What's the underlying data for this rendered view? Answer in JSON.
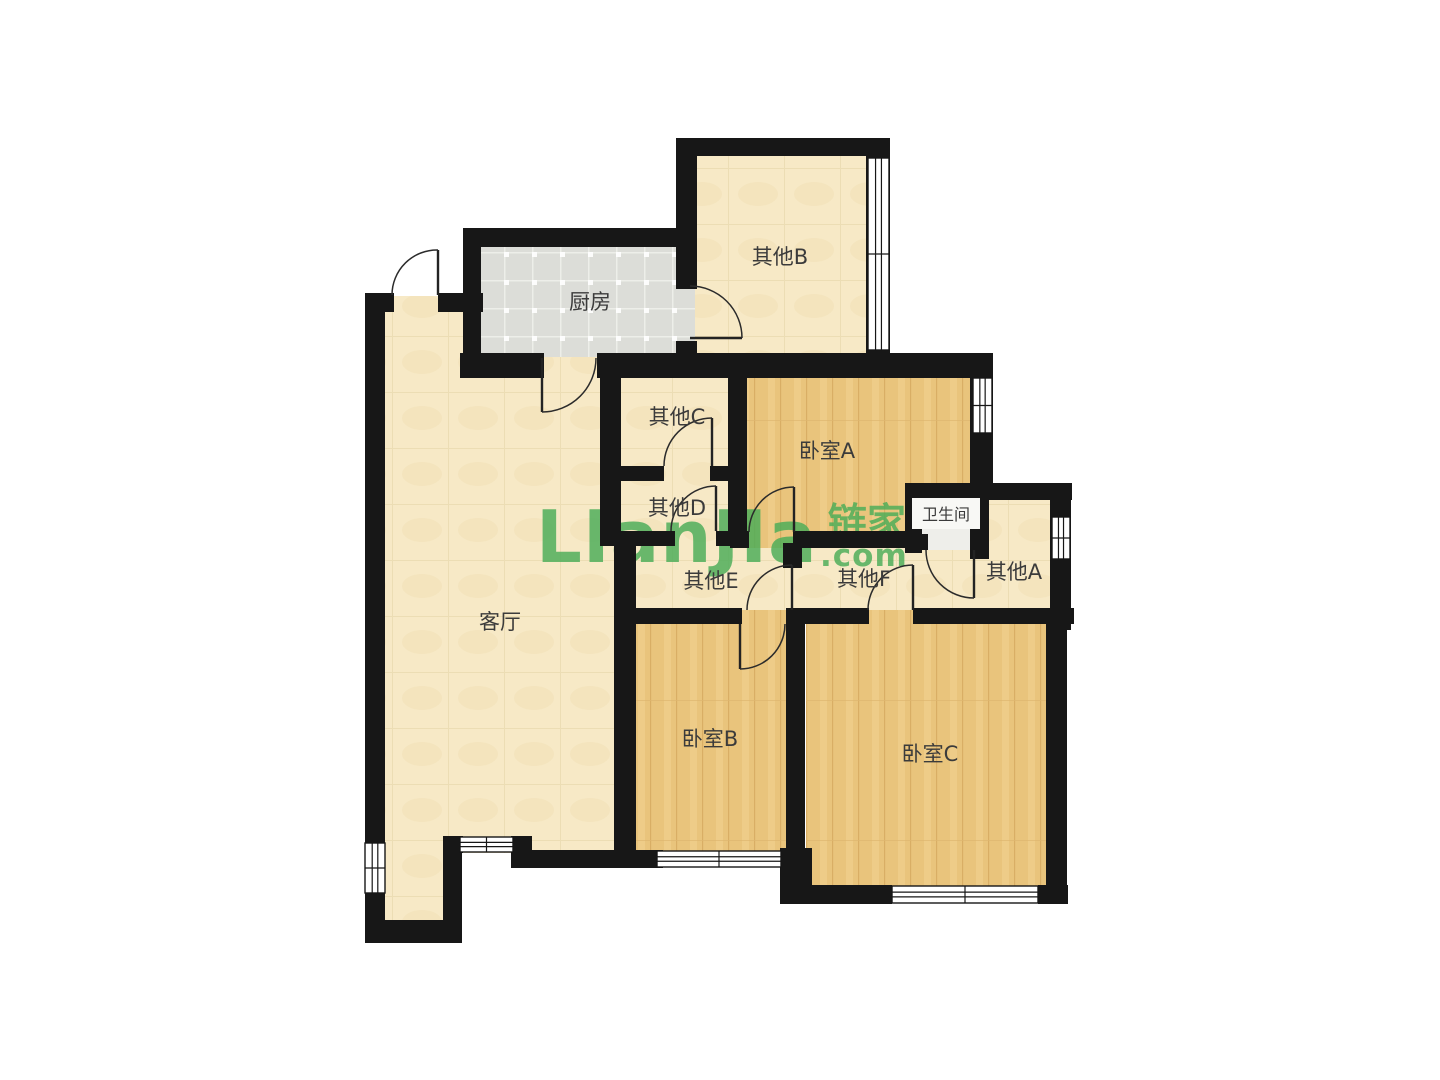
{
  "page": {
    "width": 1440,
    "height": 1080,
    "background": "#ffffff"
  },
  "watermark": {
    "latin": "LIanJIa",
    "cjk": "链家",
    "suffix": ".com",
    "color": "#4AAD58"
  },
  "palette": {
    "wall": "#171717",
    "cream_floor": "#F7E9C6",
    "wood_floor": "#E9C47C",
    "tile_floor": "#DCDDD8",
    "bath_floor": "#EEEEEA",
    "label_text": "#3B3B3B",
    "window_fill": "#FFFFFF"
  },
  "floorplan": {
    "rooms": [
      {
        "id": "living",
        "label": "客厅",
        "floor": "cream",
        "rect": [
          383,
          296,
          235,
          557
        ],
        "label_xy": [
          500,
          621
        ]
      },
      {
        "id": "foyer",
        "label": "",
        "floor": "cream",
        "rect": [
          383,
          838,
          62,
          87
        ],
        "label_xy": [
          0,
          0
        ]
      },
      {
        "id": "other-e",
        "label": "其他E",
        "floor": "cream",
        "rect": [
          634,
          531,
          152,
          79
        ],
        "label_xy": [
          711,
          580
        ]
      },
      {
        "id": "other-f",
        "label": "其他F",
        "floor": "cream",
        "rect": [
          786,
          540,
          188,
          72
        ],
        "label_xy": [
          864,
          578
        ]
      },
      {
        "id": "kitchen",
        "label": "厨房",
        "floor": "tile",
        "rect": [
          478,
          245,
          219,
          112
        ],
        "label_xy": [
          590,
          301
        ]
      },
      {
        "id": "other-b",
        "label": "其他B",
        "floor": "cream",
        "rect": [
          695,
          154,
          175,
          201
        ],
        "label_xy": [
          780,
          256
        ]
      },
      {
        "id": "other-c",
        "label": "其他C",
        "floor": "cream",
        "rect": [
          620,
          376,
          112,
          92
        ],
        "label_xy": [
          677,
          416
        ]
      },
      {
        "id": "other-d",
        "label": "其他D",
        "floor": "cream",
        "rect": [
          620,
          468,
          112,
          66
        ],
        "label_xy": [
          677,
          507
        ]
      },
      {
        "id": "bedroom-a",
        "label": "卧室A",
        "floor": "wood",
        "rect": [
          745,
          376,
          230,
          172
        ],
        "label_xy": [
          827,
          450
        ]
      },
      {
        "id": "other-a",
        "label": "其他A",
        "floor": "cream",
        "rect": [
          970,
          498,
          82,
          114
        ],
        "label_xy": [
          1014,
          571
        ]
      },
      {
        "id": "bedroom-b",
        "label": "卧室B",
        "floor": "wood",
        "rect": [
          634,
          610,
          158,
          244
        ],
        "label_xy": [
          710,
          738
        ]
      },
      {
        "id": "bedroom-c",
        "label": "卧室C",
        "floor": "wood",
        "rect": [
          806,
          610,
          242,
          277
        ],
        "label_xy": [
          930,
          753
        ]
      },
      {
        "id": "bath",
        "label": "卫生间",
        "floor": "bath",
        "rect": [
          920,
          498,
          55,
          52
        ],
        "label_xy": [
          946,
          514
        ],
        "size": 16,
        "chip": [
          912,
          498,
          68,
          31
        ]
      }
    ],
    "walls": [
      [
        365,
        293,
        20,
        650
      ],
      [
        365,
        920,
        97,
        23
      ],
      [
        443,
        850,
        19,
        93
      ],
      [
        443,
        836,
        20,
        17
      ],
      [
        511,
        836,
        21,
        32
      ],
      [
        513,
        850,
        150,
        18
      ],
      [
        365,
        293,
        29,
        19
      ],
      [
        438,
        293,
        45,
        19
      ],
      [
        463,
        228,
        18,
        130
      ],
      [
        463,
        228,
        234,
        19
      ],
      [
        676,
        138,
        21,
        151
      ],
      [
        676,
        341,
        21,
        17
      ],
      [
        676,
        138,
        214,
        18
      ],
      [
        866,
        138,
        24,
        222
      ],
      [
        460,
        353,
        84,
        25
      ],
      [
        597,
        353,
        396,
        25
      ],
      [
        600,
        353,
        21,
        192
      ],
      [
        614,
        543,
        22,
        312
      ],
      [
        618,
        466,
        46,
        15
      ],
      [
        710,
        466,
        25,
        15
      ],
      [
        728,
        353,
        19,
        193
      ],
      [
        600,
        531,
        75,
        15
      ],
      [
        716,
        531,
        32,
        15
      ],
      [
        730,
        531,
        19,
        17
      ],
      [
        793,
        531,
        127,
        17
      ],
      [
        905,
        483,
        167,
        17
      ],
      [
        905,
        483,
        17,
        70
      ],
      [
        905,
        534,
        23,
        16
      ],
      [
        970,
        483,
        19,
        76
      ],
      [
        1050,
        483,
        21,
        147
      ],
      [
        783,
        543,
        19,
        25
      ],
      [
        614,
        608,
        128,
        16
      ],
      [
        790,
        608,
        79,
        16
      ],
      [
        913,
        608,
        161,
        16
      ],
      [
        786,
        608,
        19,
        248
      ],
      [
        780,
        848,
        32,
        56
      ],
      [
        616,
        850,
        41,
        18
      ],
      [
        781,
        850,
        15,
        18
      ],
      [
        783,
        885,
        109,
        19
      ],
      [
        1038,
        885,
        30,
        19
      ],
      [
        1046,
        610,
        21,
        294
      ],
      [
        970,
        353,
        23,
        147
      ]
    ],
    "windows": [
      {
        "rect": [
          365,
          843,
          20,
          50
        ],
        "o": "v"
      },
      {
        "rect": [
          460,
          837,
          53,
          15
        ],
        "o": "h"
      },
      {
        "rect": [
          657,
          851,
          124,
          16
        ],
        "o": "h"
      },
      {
        "rect": [
          892,
          886,
          146,
          17
        ],
        "o": "h"
      },
      {
        "rect": [
          868,
          158,
          21,
          192
        ],
        "o": "v"
      },
      {
        "rect": [
          973,
          378,
          19,
          55
        ],
        "o": "v"
      },
      {
        "rect": [
          1052,
          517,
          18,
          42
        ],
        "o": "v"
      }
    ],
    "doors": [
      {
        "h": [
          438,
          295
        ],
        "t": [
          438,
          250
        ],
        "w": [
          392,
          295
        ]
      },
      {
        "h": [
          542,
          358
        ],
        "t": [
          542,
          412
        ],
        "w": [
          596,
          358
        ]
      },
      {
        "h": [
          690,
          338
        ],
        "t": [
          742,
          338
        ],
        "w": [
          690,
          286
        ]
      },
      {
        "h": [
          712,
          466
        ],
        "t": [
          712,
          418
        ],
        "w": [
          664,
          466
        ]
      },
      {
        "h": [
          716,
          531
        ],
        "t": [
          716,
          486
        ],
        "w": [
          671,
          531
        ]
      },
      {
        "h": [
          794,
          532
        ],
        "t": [
          794,
          487
        ],
        "w": [
          749,
          532
        ]
      },
      {
        "h": [
          740,
          624
        ],
        "t": [
          740,
          669
        ],
        "w": [
          785,
          624
        ]
      },
      {
        "h": [
          792,
          610
        ],
        "t": [
          792,
          565
        ],
        "w": [
          747,
          610
        ]
      },
      {
        "h": [
          913,
          610
        ],
        "t": [
          913,
          565
        ],
        "w": [
          868,
          610
        ]
      },
      {
        "h": [
          974,
          550
        ],
        "t": [
          974,
          598
        ],
        "w": [
          926,
          550
        ]
      }
    ]
  }
}
